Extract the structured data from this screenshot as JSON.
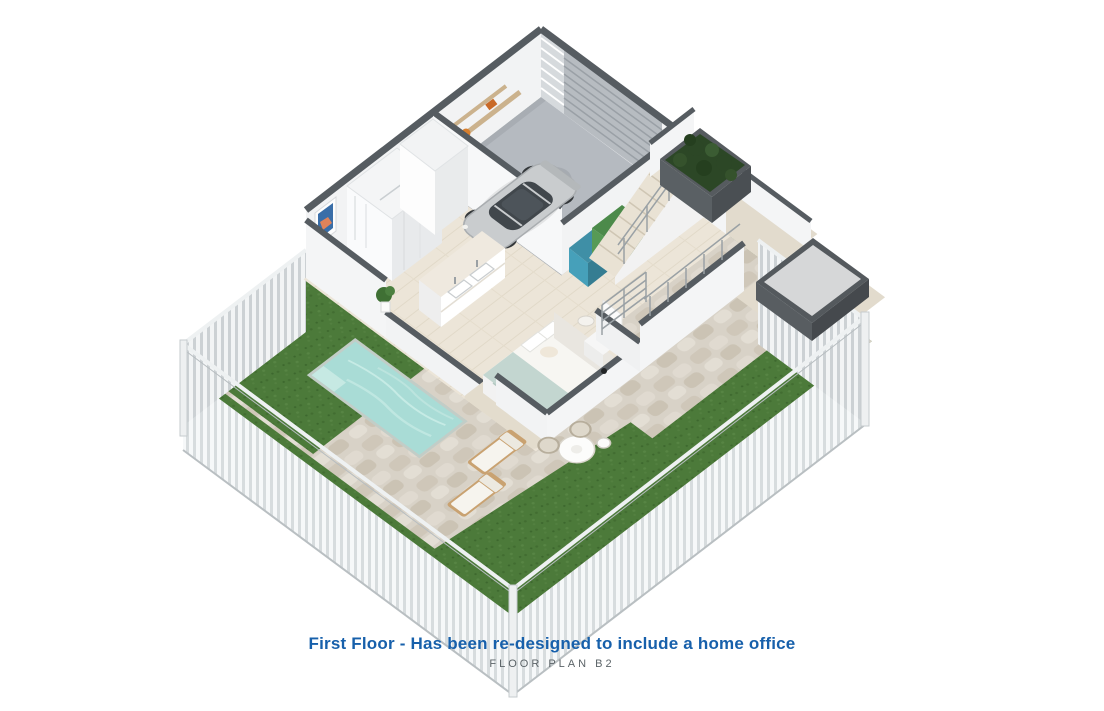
{
  "caption": {
    "title": "First Floor - Has been re-designed to include a home office",
    "subtitle": "FLOOR PLAN B2"
  },
  "colors": {
    "caption_accent": "#1760ab",
    "caption_subtitle": "#5c6468",
    "grass": "#4c7a3a",
    "pavers": "#d8d2c7",
    "pool_water": "#a9dcd6",
    "garage_floor": "#b5bac0",
    "interior_floor": "#ece5d8",
    "terrace_floor": "#e2dbcd",
    "wall_white": "#f2f3f4",
    "wall_cap": "#565c61",
    "roller_door": "#b7bcc1",
    "car_silver": "#c9ccce",
    "fence_slat": "#f2f4f5",
    "planter_foliage": "#2c4726",
    "bin_teal": "#3f8fa6",
    "bin_green": "#4c8a4a",
    "bed_blanket": "#c3d6d0",
    "lounger_wood": "#c9a271"
  },
  "scene": {
    "view": "isometric 3D floor plan render",
    "areas": [
      {
        "name": "garage",
        "objects": [
          "sports-car",
          "wall-shelves",
          "roller-door",
          "louver-window",
          "storage-bins"
        ]
      },
      {
        "name": "bathroom",
        "objects": [
          "walk-in-shower",
          "toilet",
          "wall-art",
          "wardrobe"
        ]
      },
      {
        "name": "dressing-area",
        "objects": [
          "double-vanity",
          "house-plant"
        ]
      },
      {
        "name": "bedroom",
        "objects": [
          "double-bed",
          "rug",
          "armchair",
          "side-table"
        ]
      },
      {
        "name": "staircase",
        "objects": [
          "cable-railing",
          "handrail"
        ]
      },
      {
        "name": "terrace",
        "objects": [
          "hedge-planter",
          "spa-platform",
          "parapet-walls"
        ]
      },
      {
        "name": "yard",
        "objects": [
          "swimming-pool",
          "stone-patio",
          "lawn",
          "perimeter-fence",
          "sun-loungers",
          "dining-table",
          "wicker-chairs"
        ]
      }
    ]
  }
}
